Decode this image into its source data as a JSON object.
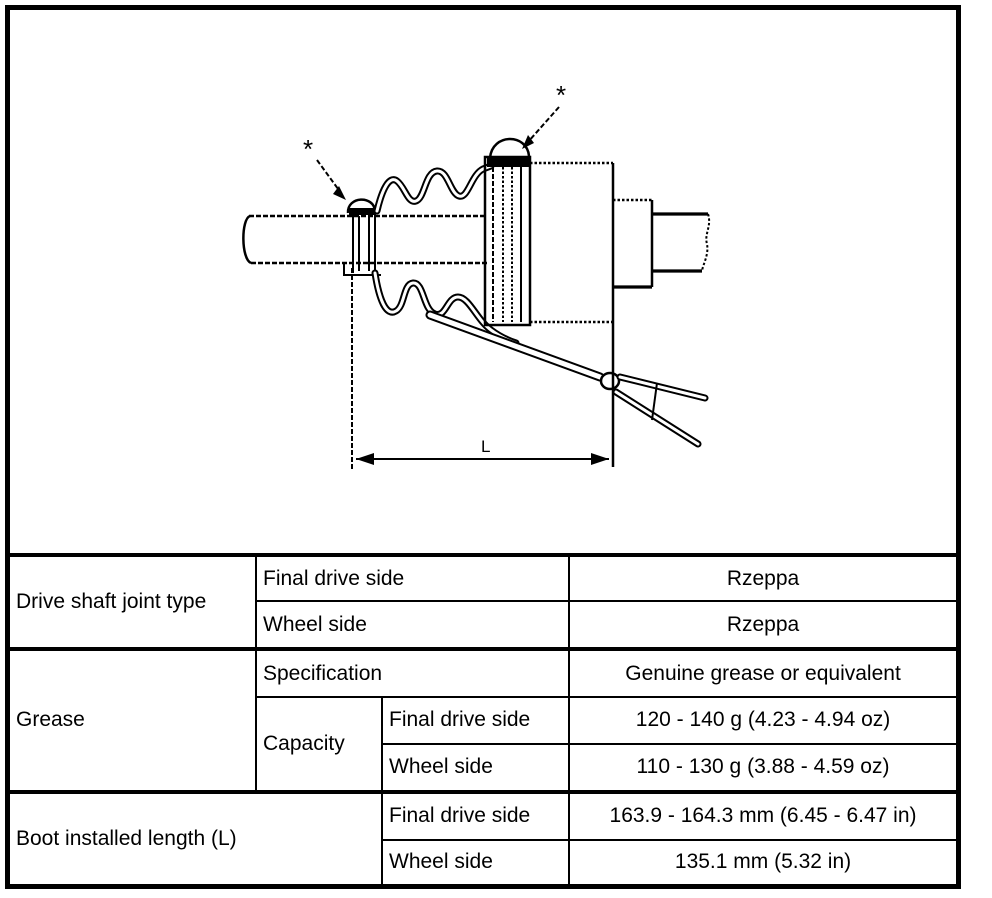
{
  "colors": {
    "ink": "#000000",
    "paper": "#ffffff"
  },
  "diagram": {
    "marker_left": "*",
    "marker_right": "*",
    "dimension_label": "L"
  },
  "spec_table": {
    "joint_type": {
      "label": "Drive shaft joint type",
      "final_drive": {
        "label": "Final drive side",
        "value": "Rzeppa"
      },
      "wheel": {
        "label": "Wheel side",
        "value": "Rzeppa"
      }
    },
    "grease": {
      "label": "Grease",
      "specification": {
        "label": "Specification",
        "value": "Genuine grease or equivalent"
      },
      "capacity": {
        "label": "Capacity",
        "final_drive": {
          "label": "Final drive side",
          "value": "120 - 140 g (4.23 - 4.94 oz)"
        },
        "wheel": {
          "label": "Wheel side",
          "value": "110 - 130 g (3.88 - 4.59 oz)"
        }
      }
    },
    "boot_installed_length": {
      "label": "Boot installed length (L)",
      "final_drive": {
        "label": "Final drive side",
        "value": "163.9 - 164.3 mm (6.45 - 6.47 in)"
      },
      "wheel": {
        "label": "Wheel side",
        "value": "135.1 mm (5.32 in)"
      }
    }
  }
}
